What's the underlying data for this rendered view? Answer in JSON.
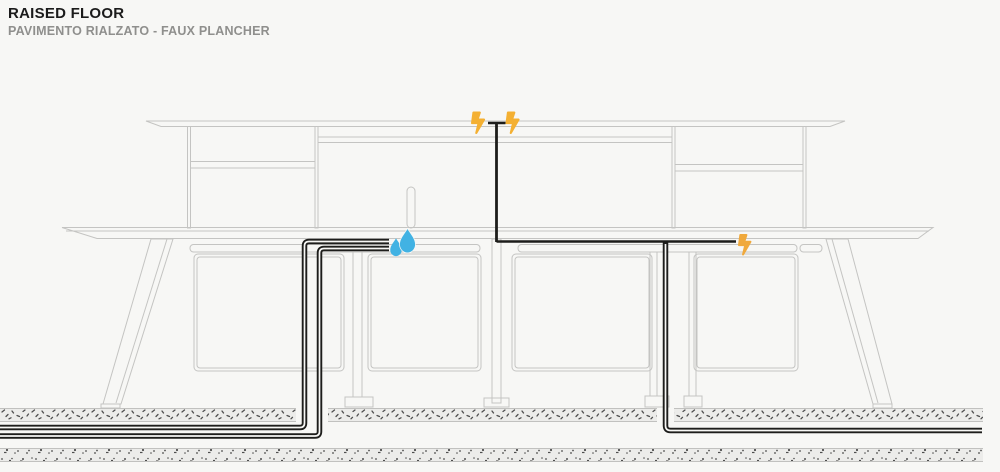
{
  "header": {
    "title": "RAISED FLOOR",
    "subtitle": "PAVIMENTO RIALZATO - FAUX PLANCHER"
  },
  "diagram": {
    "description": "Cross-section of a double-sided bench desk with overhead hutch on a raised access floor; power and water lines routed through the floor plenum",
    "utilities": {
      "electricity": {
        "icon": "lightning-bolt-icon",
        "color": "#F4B032",
        "points": 3
      },
      "water": {
        "icon": "water-drop-icon",
        "color": "#41B2E3",
        "points": 2
      }
    },
    "colors": {
      "background": "#F7F7F5",
      "furniture_line": "#C4C4C2",
      "cable": "#1D1D1B",
      "floor_fill": "#ECECEA",
      "floor_speck": "#4E4E4E"
    }
  }
}
